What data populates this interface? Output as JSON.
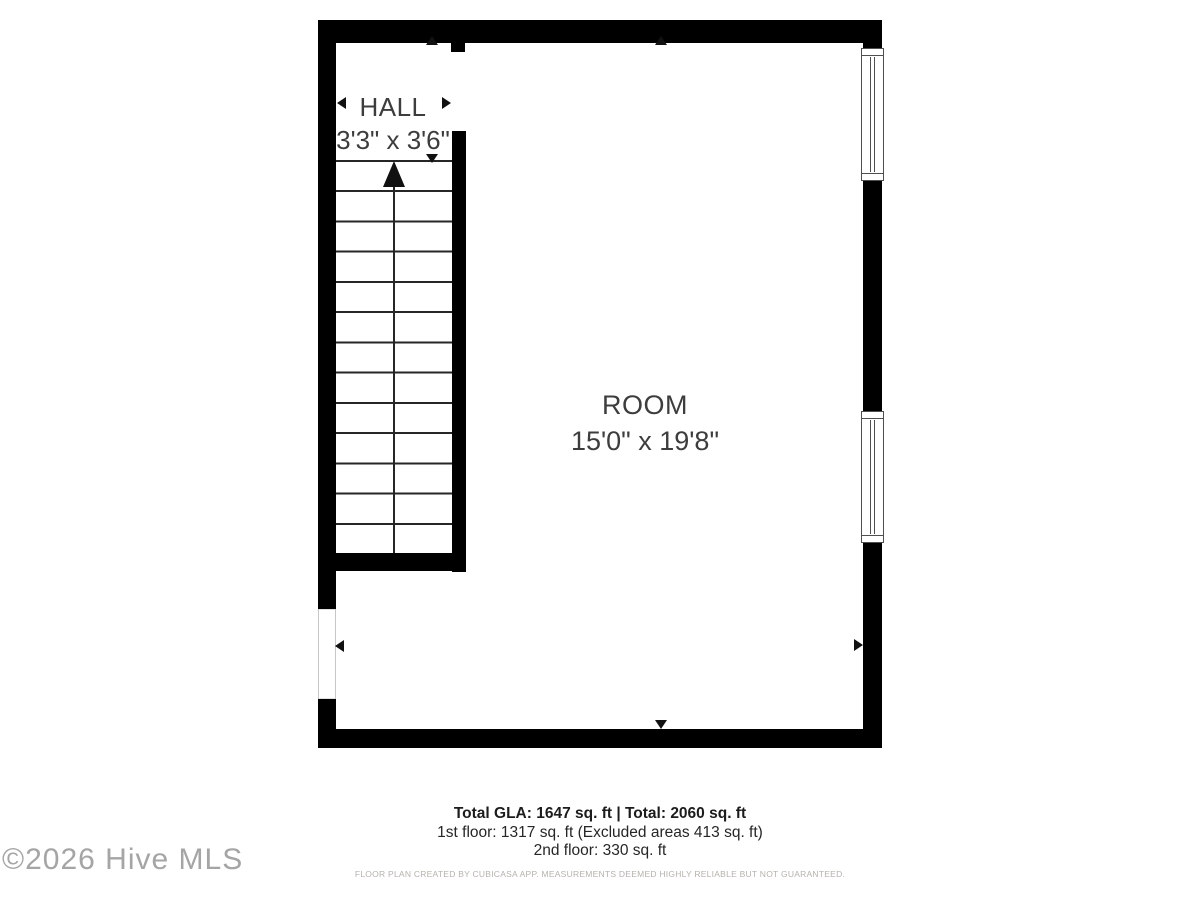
{
  "floor_plan": {
    "hall": {
      "name": "HALL",
      "dimensions": "3'3\" x 3'6\""
    },
    "room": {
      "name": "ROOM",
      "dimensions": "15'0\" x 19'8\""
    }
  },
  "summary": {
    "total": "Total GLA: 1647 sq. ft | Total: 2060 sq. ft",
    "first_floor": "1st floor: 1317 sq. ft (Excluded areas 413 sq. ft)",
    "second_floor": "2nd floor: 330 sq. ft"
  },
  "disclaimer": "FLOOR PLAN CREATED BY CUBICASA APP. MEASUREMENTS DEEMED HIGHLY RELIABLE BUT NOT GUARANTEED.",
  "watermark": "©2026 Hive MLS",
  "colors": {
    "wall": "#000000",
    "label_text": "#3d3d3d",
    "summary_text": "#262626",
    "disclaimer_text": "#b6b2ac",
    "watermark_text": "#a5a5a5",
    "window_frame": "#4f4f4f"
  }
}
